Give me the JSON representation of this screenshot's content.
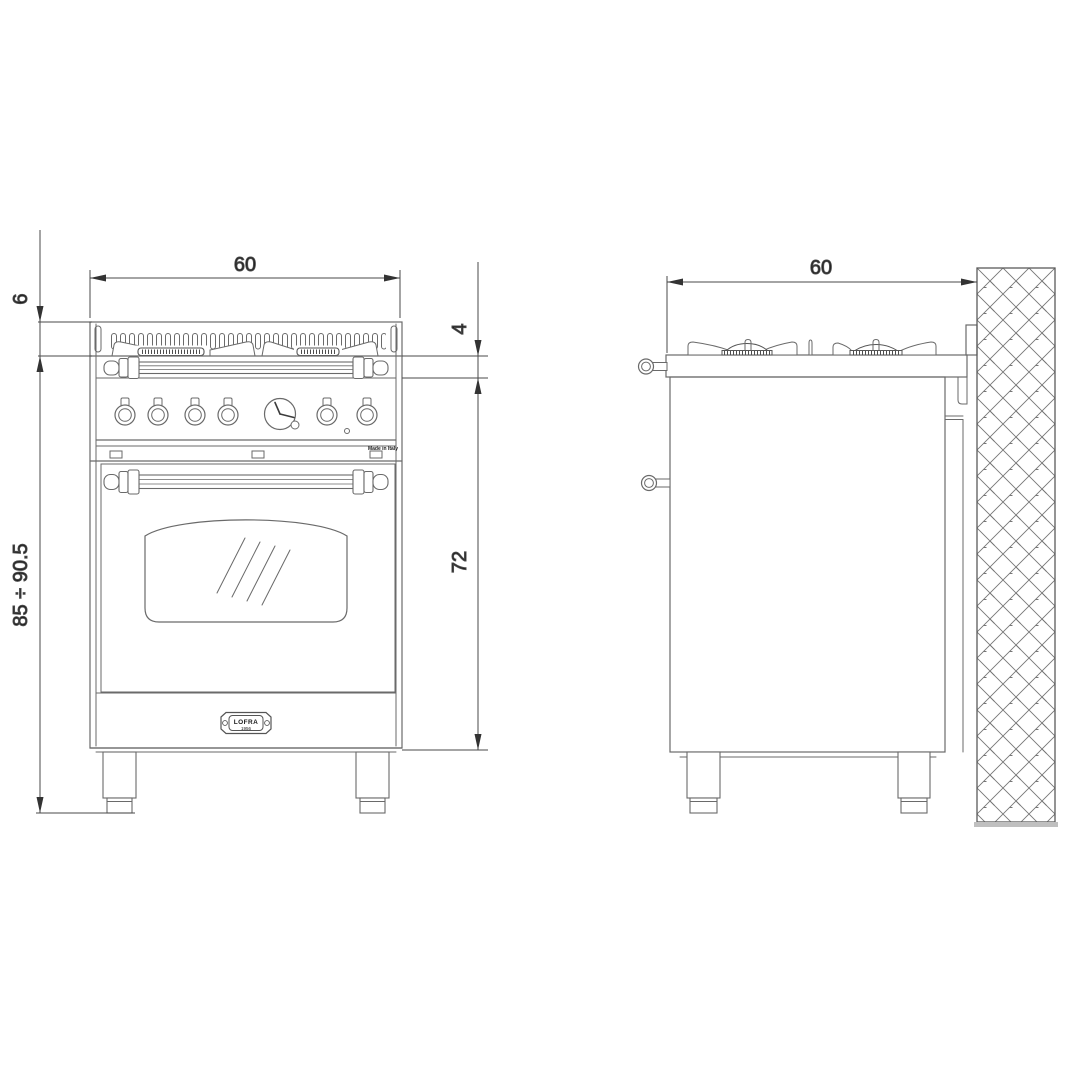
{
  "dimensions": {
    "front_width": "60",
    "backguard_height": "6",
    "overall_height": "85 ÷ 90.5",
    "worktop_edge_height": "4",
    "body_height": "72",
    "depth": "60"
  },
  "badge": {
    "brand": "LOFRA",
    "year": "1956"
  },
  "made_in_label": "Made in Italy",
  "colors": {
    "background": "#ffffff",
    "outline": "#6a6a6a",
    "dimension_line": "#4a4a4a",
    "arrow": "#333333",
    "hatch": "#777777",
    "text": "#1a1a1a"
  }
}
